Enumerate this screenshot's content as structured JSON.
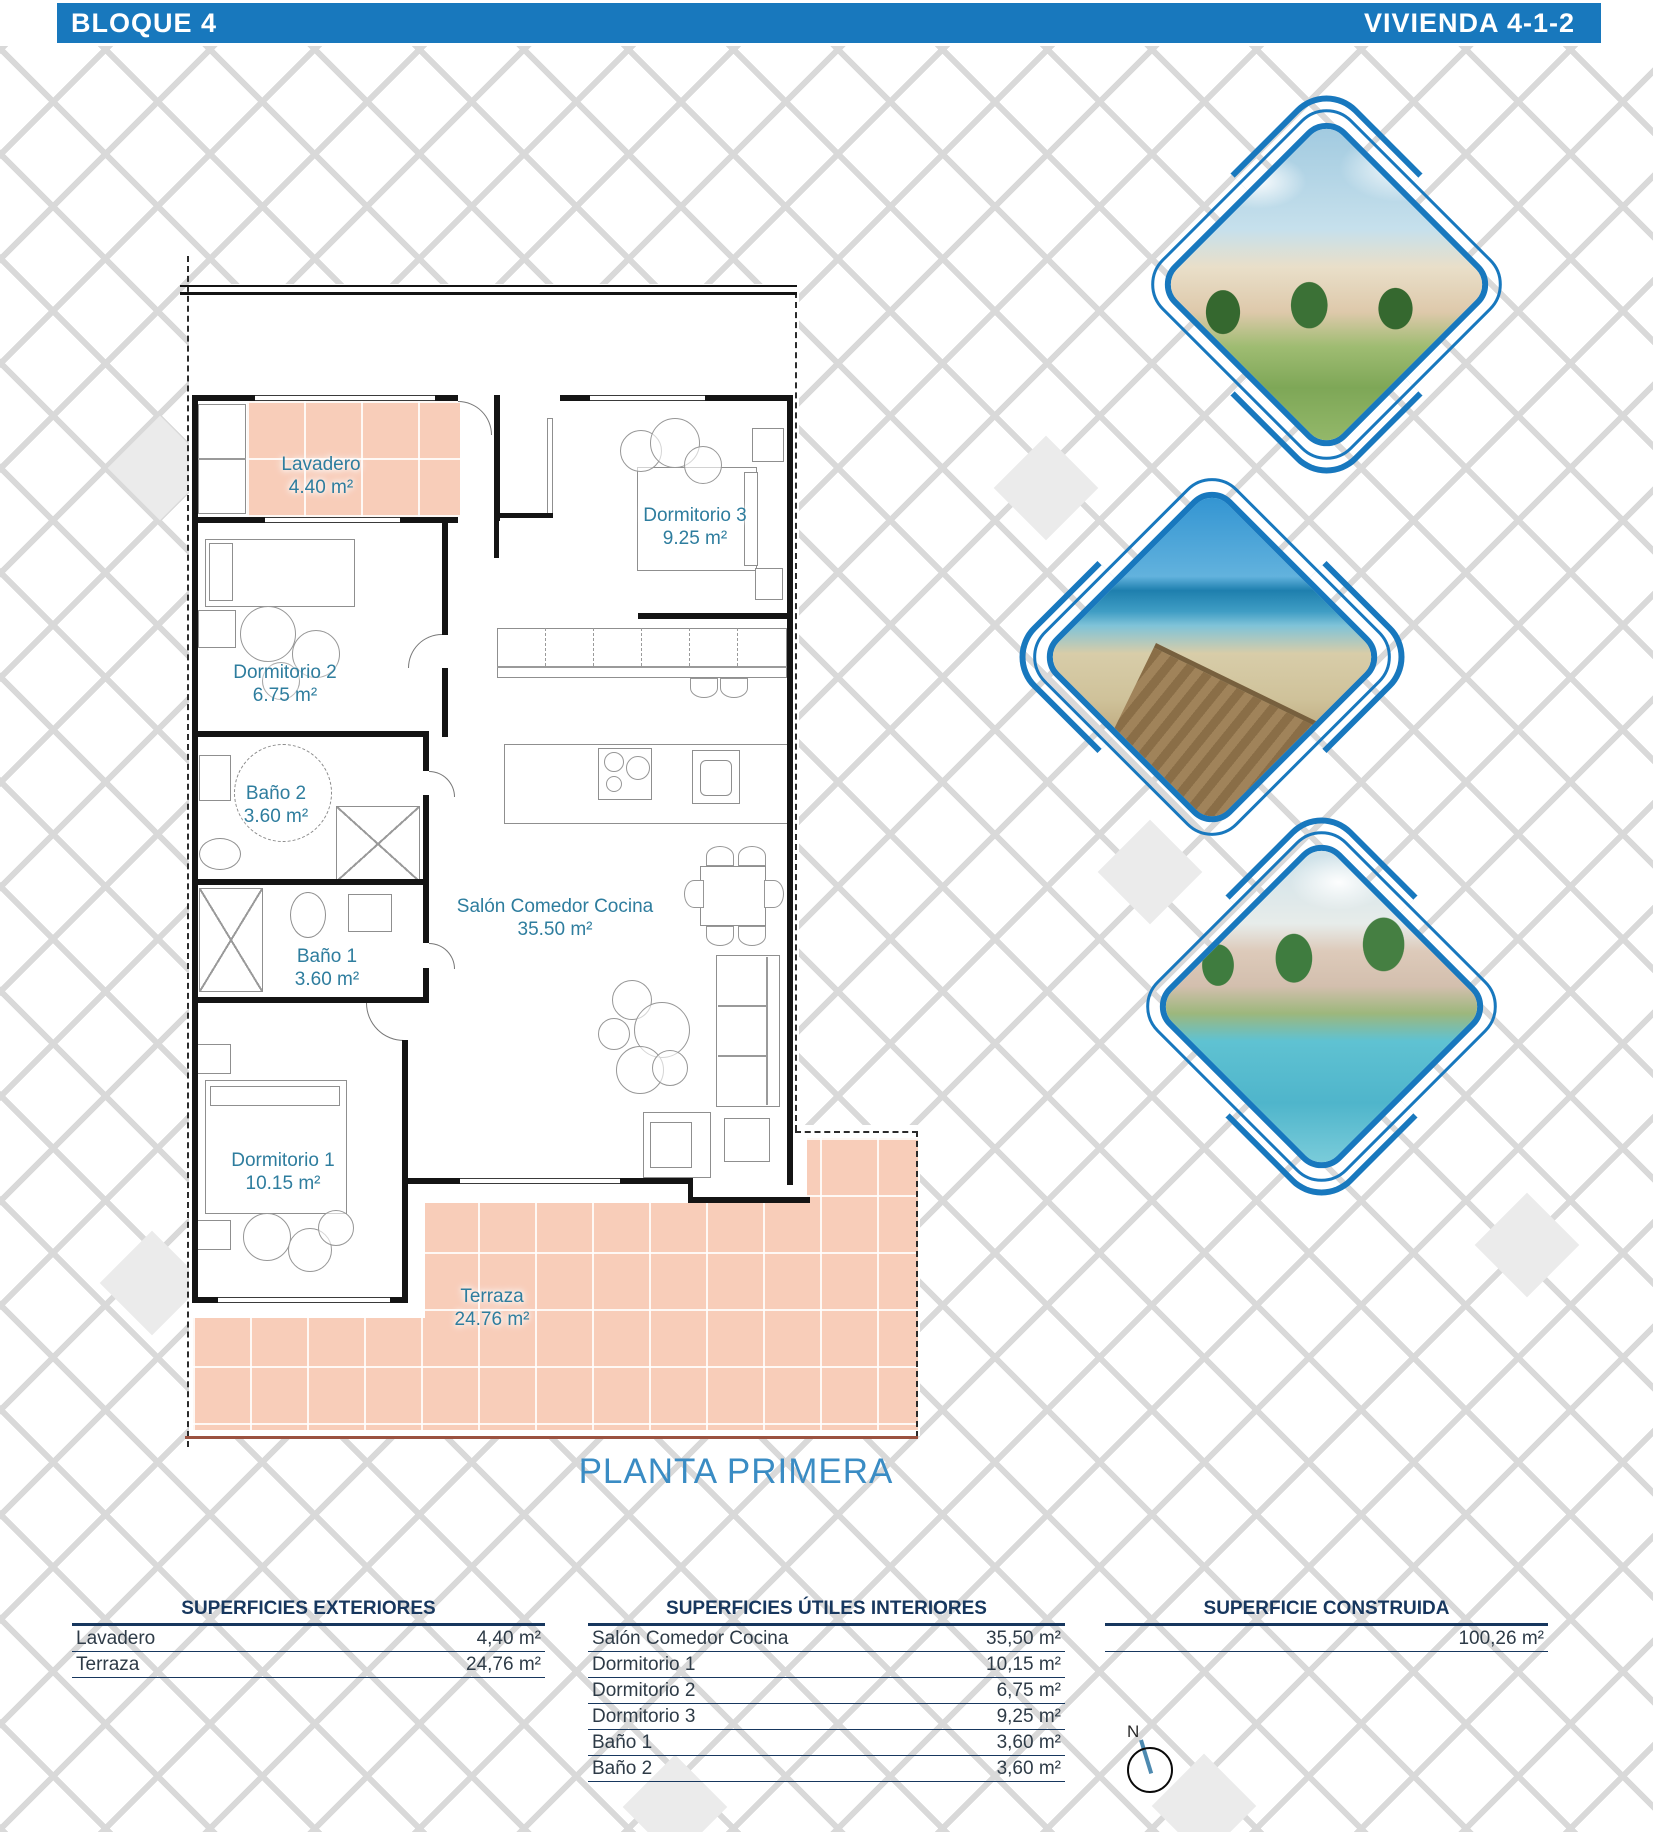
{
  "header": {
    "block": "BLOQUE 4",
    "unit": "VIVIENDA 4-1-2"
  },
  "plan": {
    "title": "PLANTA PRIMERA",
    "rooms": {
      "lavadero": {
        "name": "Lavadero",
        "area": "4.40 m²"
      },
      "dormitorio3": {
        "name": "Dormitorio 3",
        "area": "9.25 m²"
      },
      "dormitorio2": {
        "name": "Dormitorio 2",
        "area": "6.75 m²"
      },
      "bano2": {
        "name": "Baño 2",
        "area": "3.60 m²"
      },
      "bano1": {
        "name": "Baño 1",
        "area": "3.60 m²"
      },
      "salon": {
        "name": "Salón Comedor Cocina",
        "area": "35.50 m²"
      },
      "dormitorio1": {
        "name": "Dormitorio 1",
        "area": "10.15 m²"
      },
      "terraza": {
        "name": "Terraza",
        "area": "24.76 m²"
      }
    }
  },
  "tables": {
    "exteriores": {
      "title": "SUPERFICIES EXTERIORES",
      "rows": [
        {
          "label": "Lavadero",
          "value": "4,40 m²"
        },
        {
          "label": "Terraza",
          "value": "24,76 m²"
        }
      ]
    },
    "interiores": {
      "title": "SUPERFICIES ÚTILES INTERIORES",
      "rows": [
        {
          "label": "Salón Comedor Cocina",
          "value": "35,50 m²"
        },
        {
          "label": "Dormitorio 1",
          "value": "10,15 m²"
        },
        {
          "label": "Dormitorio 2",
          "value": "6,75 m²"
        },
        {
          "label": "Dormitorio 3",
          "value": "9,25 m²"
        },
        {
          "label": "Baño 1",
          "value": "3,60 m²"
        },
        {
          "label": "Baño 2",
          "value": "3,60 m²"
        }
      ]
    },
    "construida": {
      "title": "SUPERFICIE CONSTRUIDA",
      "value": "100,26 m²"
    }
  },
  "compass": {
    "north": "N"
  },
  "photos": [
    {
      "name": "render-residencial"
    },
    {
      "name": "pasarela-playa"
    },
    {
      "name": "piscina-residencial"
    }
  ],
  "colors": {
    "accent_blue": "#1878BD",
    "label_teal": "#2E7D9E",
    "table_navy": "#17375E",
    "terrace_salmon": "#F8CDB9"
  }
}
